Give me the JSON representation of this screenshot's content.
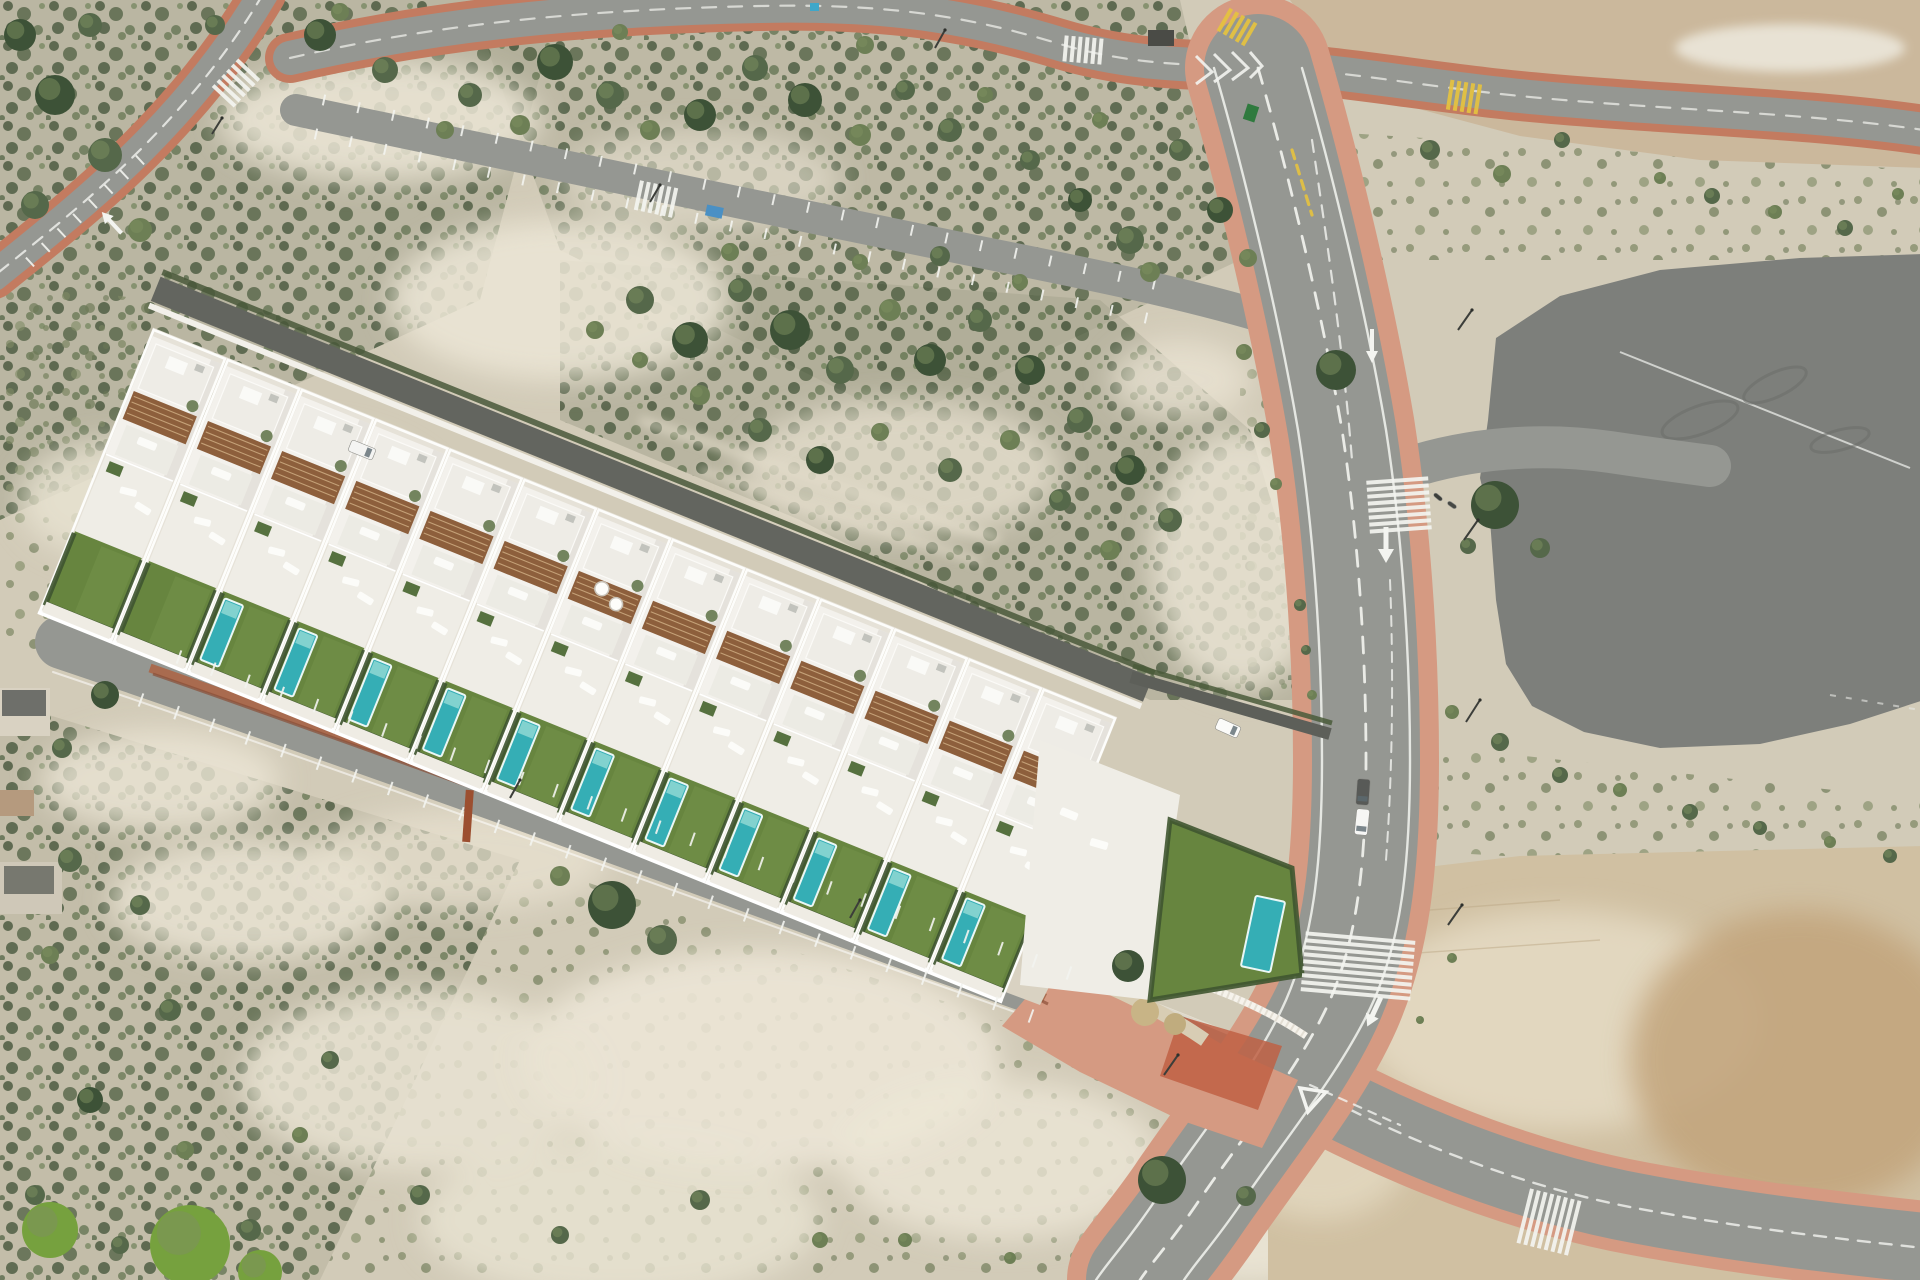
{
  "meta": {
    "description": "Aerial drone photograph of a new-build row of 13 white villas with turquoise pools and wooden pergolas, set in semi-arid scrubland. A main asphalt road with pink sidewalks, zebra crossings and parked cars runs down the right side; a large dark asphalt pad sits top right beside a graded dirt lot; smaller roads with parking bays cross the scrub at top left; bare sandy dirt fills the bottom right corner."
  },
  "palette": {
    "sand": "#d2cbb8",
    "sand_pale": "#ece6d6",
    "scrub_base": "#b2ae97",
    "asphalt": "#959792",
    "asphalt_light": "#a0a29d",
    "pad": "#7d7f7b",
    "lane_dark": "#63655f",
    "road_white": "#f3f4f0",
    "yellow": "#e5c23f",
    "pink": "#d59a82",
    "pink_deep": "#c37b60",
    "plaza_red": "#bf6044",
    "brick": "#a96b4f",
    "brick_dark": "#8a4f38",
    "stone": "#d9d2c2",
    "dirt": "#cbb89c",
    "dirt_warm": "#c2a47c",
    "villa_white": "#f3f1ec",
    "villa_shade": "#dcd9d2",
    "villa_roof": "#eeece6",
    "villa_roof2": "#ecebe4",
    "villa_terrace": "#efede6",
    "plot": "#e6e2d8",
    "pergola": "#8d5f3c",
    "lawn": "#67853f",
    "pool": "#35aeb5",
    "pool_light": "#8fd8d4",
    "hedge": "#3f5530",
    "tree_fills": [
      "#3d5237",
      "#55684a",
      "#6d7f55",
      "#76a13e"
    ],
    "tree_highlight": "#7e9060"
  },
  "scene": {
    "villas": {
      "count": 13,
      "units": [
        {
          "pool": false,
          "jacuzzi": false
        },
        {
          "pool": false,
          "jacuzzi": false
        },
        {
          "pool": true,
          "jacuzzi": false
        },
        {
          "pool": true,
          "jacuzzi": false
        },
        {
          "pool": true,
          "jacuzzi": false
        },
        {
          "pool": true,
          "jacuzzi": false
        },
        {
          "pool": true,
          "jacuzzi": true
        },
        {
          "pool": true,
          "jacuzzi": false
        },
        {
          "pool": true,
          "jacuzzi": false
        },
        {
          "pool": true,
          "jacuzzi": false
        },
        {
          "pool": true,
          "jacuzzi": false
        },
        {
          "pool": true,
          "jacuzzi": false
        },
        {
          "pool": true,
          "jacuzzi": true
        }
      ]
    },
    "trees": [
      [
        20,
        35,
        16,
        0
      ],
      [
        55,
        95,
        20,
        0
      ],
      [
        105,
        155,
        17,
        1
      ],
      [
        35,
        205,
        14,
        1
      ],
      [
        140,
        230,
        12,
        2
      ],
      [
        90,
        25,
        12,
        1
      ],
      [
        215,
        25,
        10,
        1
      ],
      [
        320,
        35,
        16,
        0
      ],
      [
        385,
        70,
        13,
        1
      ],
      [
        340,
        12,
        9,
        2
      ],
      [
        470,
        95,
        12,
        1
      ],
      [
        520,
        125,
        10,
        2
      ],
      [
        555,
        62,
        18,
        0
      ],
      [
        610,
        95,
        14,
        1
      ],
      [
        650,
        130,
        10,
        2
      ],
      [
        700,
        115,
        16,
        0
      ],
      [
        755,
        68,
        13,
        1
      ],
      [
        805,
        100,
        17,
        0
      ],
      [
        860,
        135,
        11,
        2
      ],
      [
        905,
        90,
        10,
        1
      ],
      [
        950,
        130,
        12,
        1
      ],
      [
        865,
        45,
        9,
        2
      ],
      [
        620,
        32,
        8,
        2
      ],
      [
        985,
        95,
        8,
        2
      ],
      [
        445,
        130,
        9,
        2
      ],
      [
        1030,
        160,
        10,
        1
      ],
      [
        1080,
        200,
        12,
        0
      ],
      [
        1130,
        240,
        14,
        1
      ],
      [
        1180,
        150,
        11,
        1
      ],
      [
        1220,
        210,
        13,
        0
      ],
      [
        1150,
        272,
        10,
        2
      ],
      [
        1100,
        120,
        8,
        2
      ],
      [
        1248,
        258,
        9,
        2
      ],
      [
        640,
        300,
        14,
        1
      ],
      [
        690,
        340,
        18,
        0
      ],
      [
        740,
        290,
        12,
        1
      ],
      [
        790,
        330,
        20,
        0
      ],
      [
        840,
        370,
        14,
        1
      ],
      [
        890,
        310,
        11,
        2
      ],
      [
        930,
        360,
        16,
        0
      ],
      [
        980,
        320,
        12,
        1
      ],
      [
        1030,
        370,
        15,
        0
      ],
      [
        1080,
        420,
        13,
        1
      ],
      [
        1130,
        470,
        15,
        0
      ],
      [
        1170,
        520,
        12,
        1
      ],
      [
        700,
        395,
        10,
        2
      ],
      [
        760,
        430,
        12,
        1
      ],
      [
        820,
        460,
        14,
        0
      ],
      [
        880,
        432,
        9,
        2
      ],
      [
        950,
        470,
        12,
        1
      ],
      [
        1010,
        440,
        10,
        2
      ],
      [
        1060,
        500,
        11,
        1
      ],
      [
        1110,
        550,
        10,
        2
      ],
      [
        640,
        360,
        8,
        2
      ],
      [
        730,
        252,
        9,
        2
      ],
      [
        860,
        262,
        8,
        2
      ],
      [
        940,
        256,
        10,
        1
      ],
      [
        1020,
        282,
        8,
        2
      ],
      [
        595,
        330,
        9,
        2
      ],
      [
        1262,
        430,
        8,
        1
      ],
      [
        1276,
        484,
        6,
        2
      ],
      [
        1300,
        605,
        6,
        1
      ],
      [
        1306,
        650,
        5,
        1
      ],
      [
        1312,
        695,
        5,
        2
      ],
      [
        1336,
        370,
        20,
        0
      ],
      [
        1244,
        352,
        8,
        2
      ],
      [
        1495,
        505,
        24,
        0
      ],
      [
        1540,
        548,
        10,
        1
      ],
      [
        1468,
        546,
        8,
        1
      ],
      [
        1500,
        742,
        9,
        1
      ],
      [
        1560,
        775,
        8,
        1
      ],
      [
        1620,
        790,
        7,
        2
      ],
      [
        1690,
        812,
        8,
        1
      ],
      [
        1760,
        828,
        7,
        1
      ],
      [
        1830,
        842,
        6,
        2
      ],
      [
        1890,
        856,
        7,
        1
      ],
      [
        1452,
        712,
        7,
        2
      ],
      [
        1712,
        196,
        8,
        1
      ],
      [
        1775,
        212,
        7,
        2
      ],
      [
        1845,
        228,
        8,
        1
      ],
      [
        1898,
        194,
        6,
        2
      ],
      [
        1660,
        178,
        6,
        2
      ],
      [
        1430,
        150,
        10,
        1
      ],
      [
        1502,
        174,
        9,
        2
      ],
      [
        1562,
        140,
        8,
        1
      ],
      [
        612,
        905,
        24,
        0
      ],
      [
        662,
        940,
        15,
        1
      ],
      [
        1128,
        966,
        16,
        0
      ],
      [
        560,
        876,
        10,
        2
      ],
      [
        1162,
        1180,
        24,
        0
      ],
      [
        1246,
        1196,
        10,
        1
      ],
      [
        70,
        860,
        12,
        1
      ],
      [
        140,
        905,
        10,
        1
      ],
      [
        50,
        955,
        9,
        2
      ],
      [
        170,
        1010,
        11,
        1
      ],
      [
        90,
        1100,
        13,
        0
      ],
      [
        35,
        1195,
        10,
        1
      ],
      [
        185,
        1150,
        9,
        2
      ],
      [
        250,
        1230,
        11,
        1
      ],
      [
        330,
        1060,
        9,
        1
      ],
      [
        300,
        1135,
        8,
        2
      ],
      [
        420,
        1195,
        10,
        1
      ],
      [
        560,
        1235,
        9,
        1
      ],
      [
        700,
        1200,
        10,
        1
      ],
      [
        820,
        1240,
        8,
        2
      ],
      [
        120,
        1245,
        9,
        1
      ],
      [
        105,
        695,
        14,
        0
      ],
      [
        62,
        748,
        10,
        1
      ],
      [
        50,
        1230,
        28,
        3
      ],
      [
        190,
        1245,
        40,
        3
      ],
      [
        260,
        1272,
        22,
        3
      ],
      [
        905,
        1240,
        7,
        2
      ],
      [
        1010,
        1258,
        6,
        2
      ],
      [
        1452,
        958,
        5,
        2
      ],
      [
        1420,
        1020,
        4,
        2
      ]
    ],
    "parking_rows": [
      {
        "x1": 179,
        "y1": 657,
        "x2": 1069,
        "y2": 973,
        "n": 26,
        "len": 14
      },
      {
        "x1": 141,
        "y1": 700,
        "x2": 1031,
        "y2": 1016,
        "n": 25,
        "len": 14
      },
      {
        "x1": 324,
        "y1": 100,
        "x2": 1154,
        "y2": 284,
        "n": 24,
        "len": 11
      },
      {
        "x1": 316,
        "y1": 134,
        "x2": 1146,
        "y2": 318,
        "n": 24,
        "len": 11
      },
      {
        "x1": 140,
        "y1": 160,
        "x2": 30,
        "y2": 262,
        "n": 7,
        "len": 12
      }
    ],
    "crosswalks": [
      {
        "x": 236,
        "y": 83,
        "rot": 43,
        "len": 30,
        "n": 6,
        "color": "#f3f4f0"
      },
      {
        "x": 1083,
        "y": 50,
        "rot": 95,
        "len": 26,
        "n": 6,
        "color": "#f3f4f0"
      },
      {
        "x": 656,
        "y": 199,
        "rot": 102,
        "len": 30,
        "n": 6,
        "color": "#f3f4f0"
      },
      {
        "x": 1399,
        "y": 505,
        "rot": 176,
        "len": 62,
        "n": 8,
        "color": "#f3f4f0"
      },
      {
        "x": 1358,
        "y": 966,
        "rot": 185,
        "len": 110,
        "n": 9,
        "color": "#f3f4f0"
      },
      {
        "x": 1549,
        "y": 1222,
        "rot": 104,
        "len": 56,
        "n": 8,
        "color": "#f3f4f0"
      },
      {
        "x": 1237,
        "y": 27,
        "rot": 120,
        "len": 26,
        "n": 5,
        "color": "#e5c23f"
      },
      {
        "x": 1464,
        "y": 97,
        "rot": 99,
        "len": 30,
        "n": 5,
        "color": "#e5c23f"
      }
    ],
    "cars": [
      {
        "x": 362,
        "y": 450,
        "w": 26,
        "h": 12,
        "rot": 22,
        "body": "#f4f4f2",
        "kind": "van-on-rear-lane"
      },
      {
        "x": 1228,
        "y": 728,
        "w": 24,
        "h": 12,
        "rot": 24,
        "body": "#fbfbf9",
        "kind": "car-at-villa-corner"
      },
      {
        "x": 1363,
        "y": 792,
        "w": 26,
        "h": 13,
        "rot": 94,
        "body": "#585a57",
        "kind": "parked-dark-car"
      },
      {
        "x": 1362,
        "y": 822,
        "w": 26,
        "h": 13,
        "rot": 96,
        "body": "#f6f6f4",
        "kind": "parked-white-car"
      },
      {
        "x": 1438,
        "y": 497,
        "w": 10,
        "h": 4,
        "rot": 40,
        "body": "#3c3e3a",
        "kind": "scooter"
      },
      {
        "x": 1452,
        "y": 505,
        "w": 10,
        "h": 4,
        "rot": 35,
        "body": "#464844",
        "kind": "scooter"
      }
    ],
    "poles": [
      [
        1472,
        310,
        1458,
        330
      ],
      [
        1478,
        520,
        1464,
        540
      ],
      [
        1480,
        700,
        1466,
        722
      ],
      [
        1462,
        905,
        1448,
        925
      ],
      [
        945,
        30,
        935,
        48
      ],
      [
        660,
        185,
        650,
        202
      ],
      [
        222,
        118,
        212,
        134
      ],
      [
        1178,
        1055,
        1164,
        1075
      ],
      [
        520,
        780,
        510,
        798
      ],
      [
        860,
        900,
        850,
        918
      ]
    ],
    "props": {
      "dumpster_color": "#2f7a3e",
      "sign_color": "#3fa7c9"
    }
  }
}
